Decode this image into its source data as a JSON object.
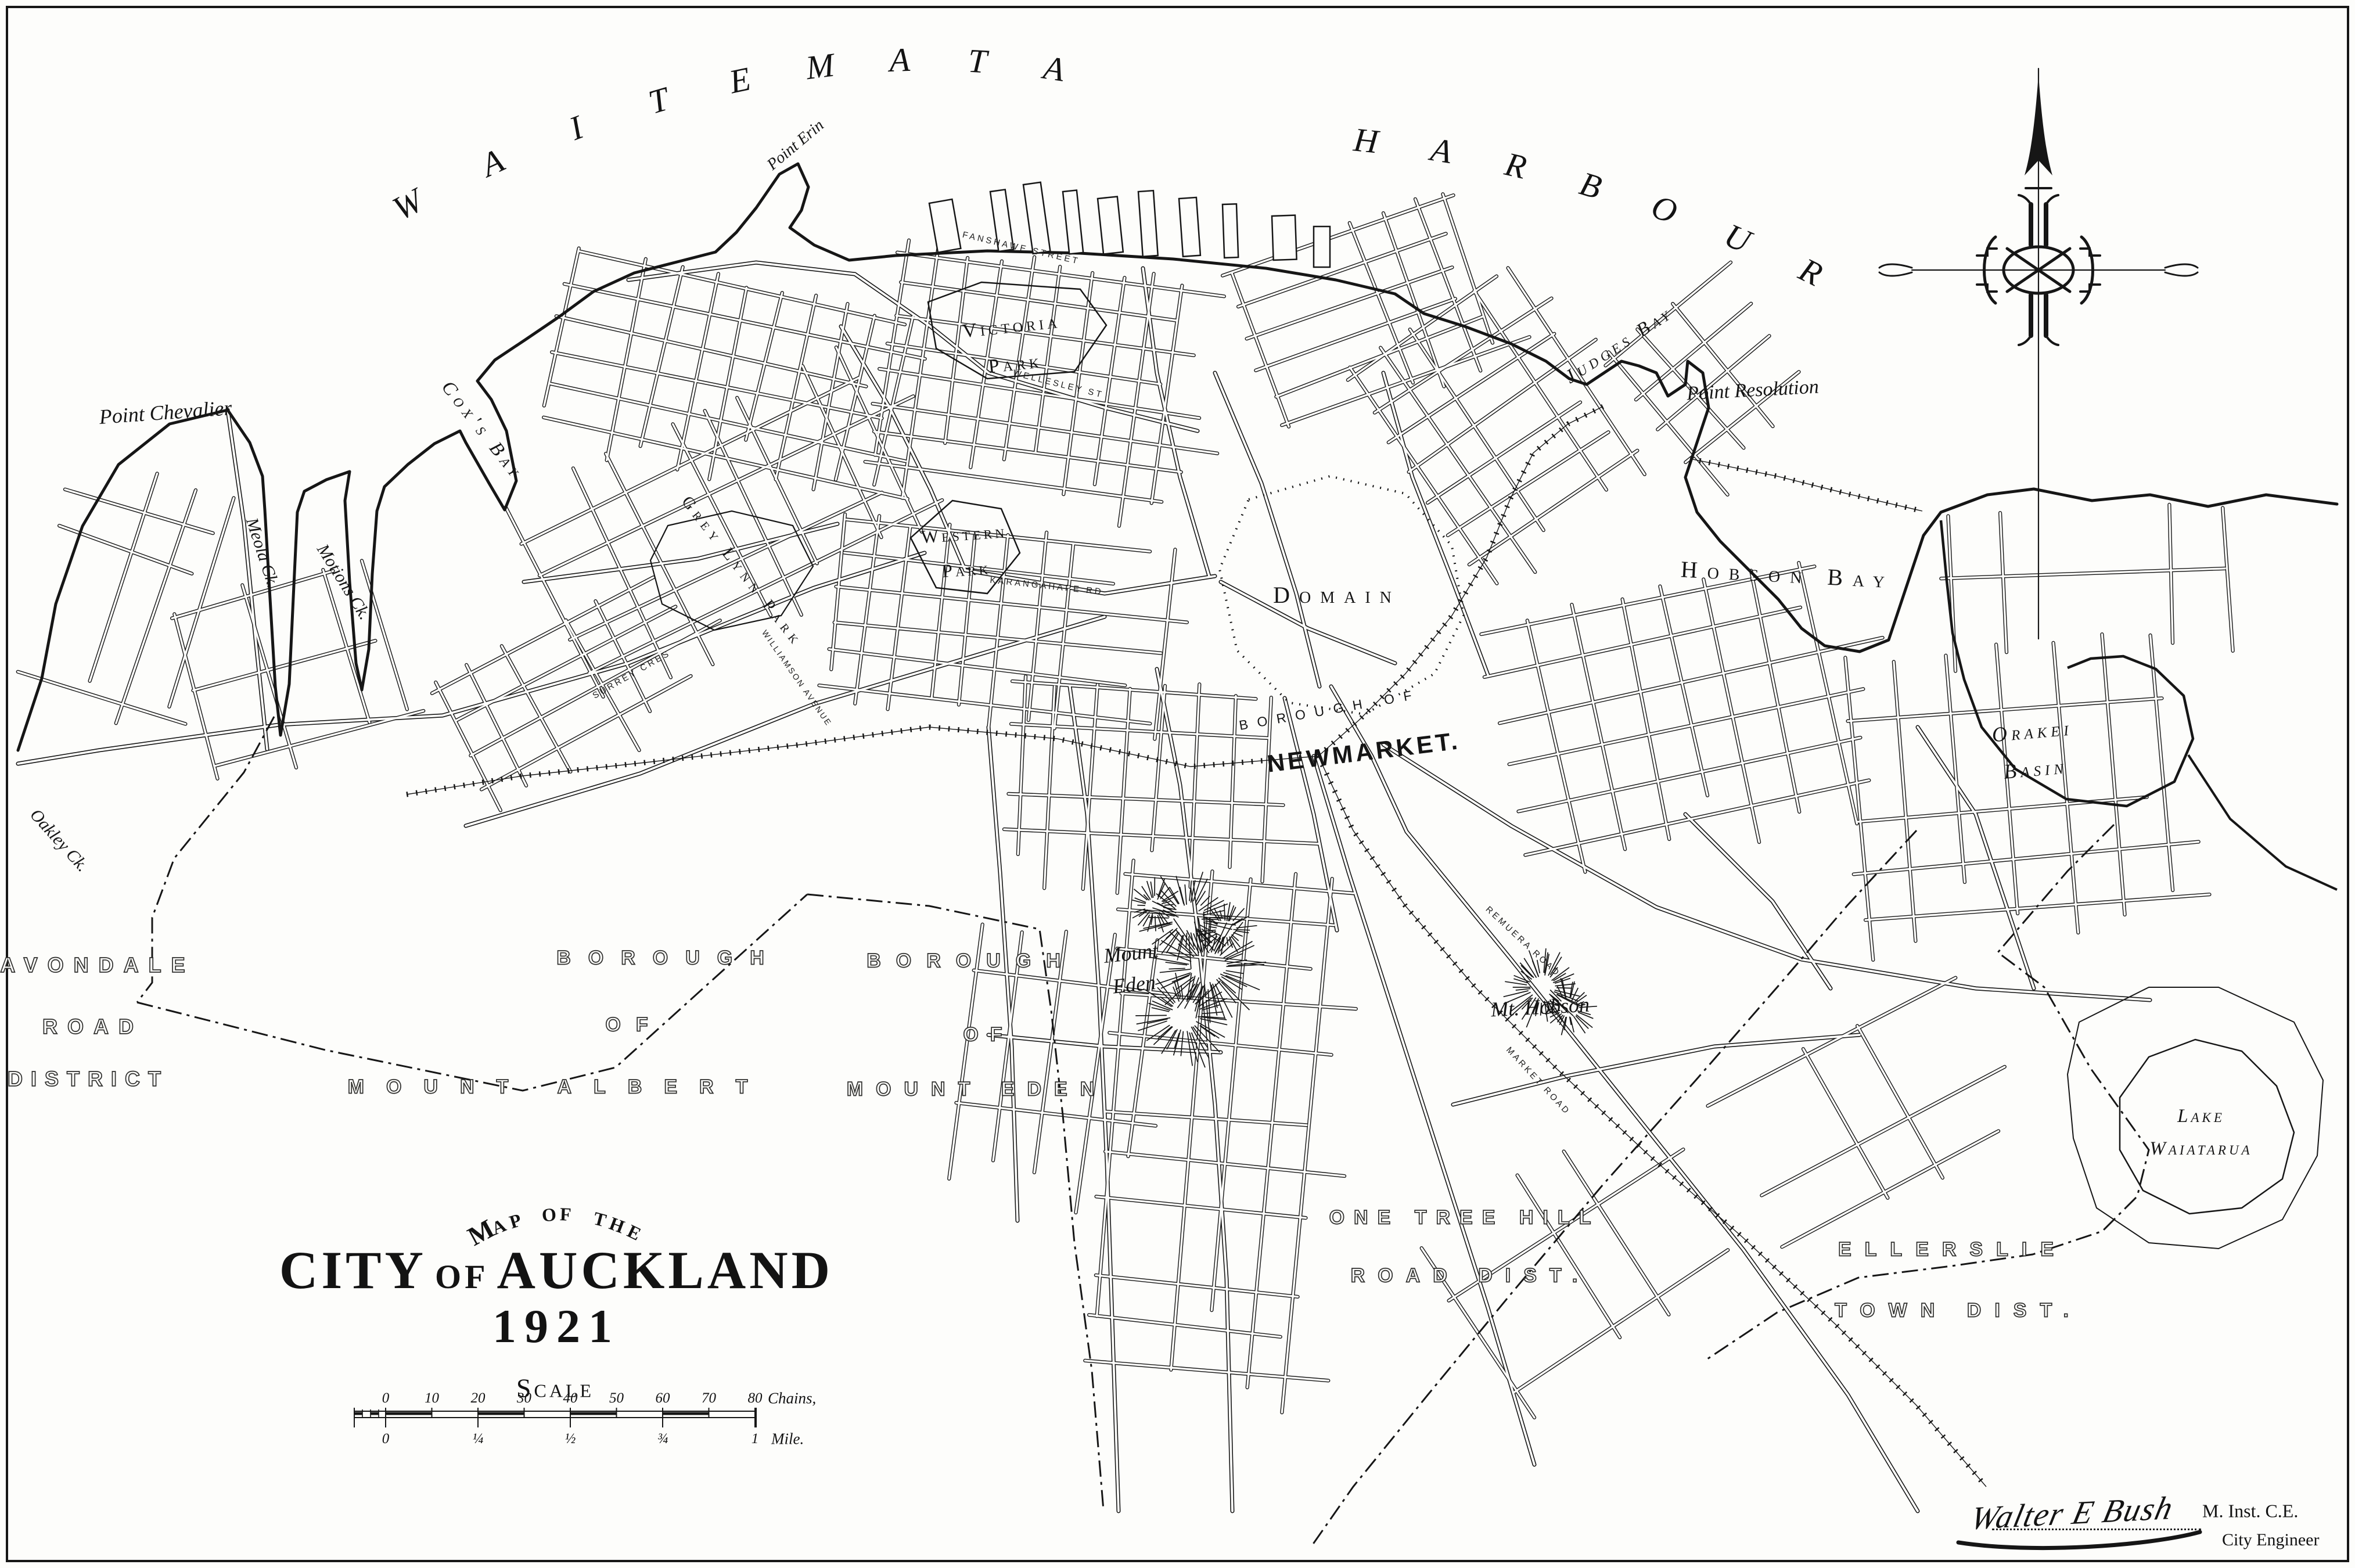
{
  "title": {
    "prefix": "Map of the",
    "city": "CITY",
    "of": "OF",
    "auckland": "AUCKLAND",
    "year": "1921"
  },
  "scale": {
    "label": "Scale",
    "chains_ticks": [
      "0",
      "10",
      "20",
      "30",
      "40",
      "50",
      "60",
      "70",
      "80"
    ],
    "chains_unit": "Chains,",
    "mile_ticks": [
      "0",
      "¼",
      "½",
      "¾",
      "1"
    ],
    "mile_unit": "Mile."
  },
  "signature": {
    "name": "Walter E Bush",
    "credential": "M. Inst. C.E.",
    "role": "City Engineer"
  },
  "compass": {
    "icon": "north-arrow"
  },
  "colors": {
    "ink": "#161616",
    "paper": "#fdfdfb"
  },
  "map_labels": [
    {
      "id": "waitemata",
      "text": "WAITEMATA"
    },
    {
      "id": "harbour",
      "text": "HARBOUR"
    },
    {
      "id": "map-of-the",
      "text": "Map of the"
    },
    {
      "id": "point-erin",
      "text": "Point Erin"
    },
    {
      "id": "point-chevalier",
      "text": "Point Chevalier"
    },
    {
      "id": "coxs-bay",
      "text": "Cox's Bay"
    },
    {
      "id": "meola-ck",
      "text": "Meola Ck."
    },
    {
      "id": "motions-ck",
      "text": "Motions Ck."
    },
    {
      "id": "oakley-ck",
      "text": "Oakley Ck."
    },
    {
      "id": "victoria-park",
      "text": "Victoria\nPark"
    },
    {
      "id": "western-park",
      "text": "Western\nPark"
    },
    {
      "id": "grey-lynn-park",
      "text": "Grey Lynn Park"
    },
    {
      "id": "domain",
      "text": "Domain"
    },
    {
      "id": "borough-of-newmarket",
      "text": "BOROUGH OF"
    },
    {
      "id": "newmarket",
      "text": "NEWMARKET."
    },
    {
      "id": "judges-bay",
      "text": "Judges Bay"
    },
    {
      "id": "point-resolution",
      "text": "Point Resolution"
    },
    {
      "id": "hobson-bay",
      "text": "Hobson Bay"
    },
    {
      "id": "orakei-basin",
      "text": "Orakei\nBasin"
    },
    {
      "id": "lake-waiatarua",
      "text": "Lake\nWaiatarua"
    },
    {
      "id": "mount-eden-hill",
      "text": "Mount\nEden"
    },
    {
      "id": "mt-hobson",
      "text": "Mt. Hobson"
    },
    {
      "id": "avondale-1",
      "text": "AVONDALE"
    },
    {
      "id": "avondale-2",
      "text": "ROAD"
    },
    {
      "id": "avondale-3",
      "text": "DISTRICT"
    },
    {
      "id": "mtalbert-1",
      "text": "BOROUGH"
    },
    {
      "id": "mtalbert-2",
      "text": "OF"
    },
    {
      "id": "mtalbert-3",
      "text": "MOUNT ALBERT"
    },
    {
      "id": "mteden-1",
      "text": "BOROUGH"
    },
    {
      "id": "mteden-2",
      "text": "OF"
    },
    {
      "id": "mteden-3",
      "text": "MOUNT EDEN"
    },
    {
      "id": "onetreehill-1",
      "text": "ONE TREE HILL"
    },
    {
      "id": "onetreehill-2",
      "text": "ROAD DIST."
    },
    {
      "id": "ellerslie-1",
      "text": "ELLERSLIE"
    },
    {
      "id": "ellerslie-2",
      "text": "TOWN DIST."
    },
    {
      "id": "st-fanshawe",
      "text": "FANSHAWE STREET"
    },
    {
      "id": "st-wellesley",
      "text": "WELLESLEY ST"
    },
    {
      "id": "st-karangahape",
      "text": "KARANGAHAPE RD"
    },
    {
      "id": "st-surrey",
      "text": "SURREY CRES"
    },
    {
      "id": "st-williamson",
      "text": "WILLIAMSON AVENUE"
    },
    {
      "id": "st-remuera",
      "text": "REMUERA ROAD"
    },
    {
      "id": "st-market",
      "text": "MARKET ROAD"
    }
  ]
}
